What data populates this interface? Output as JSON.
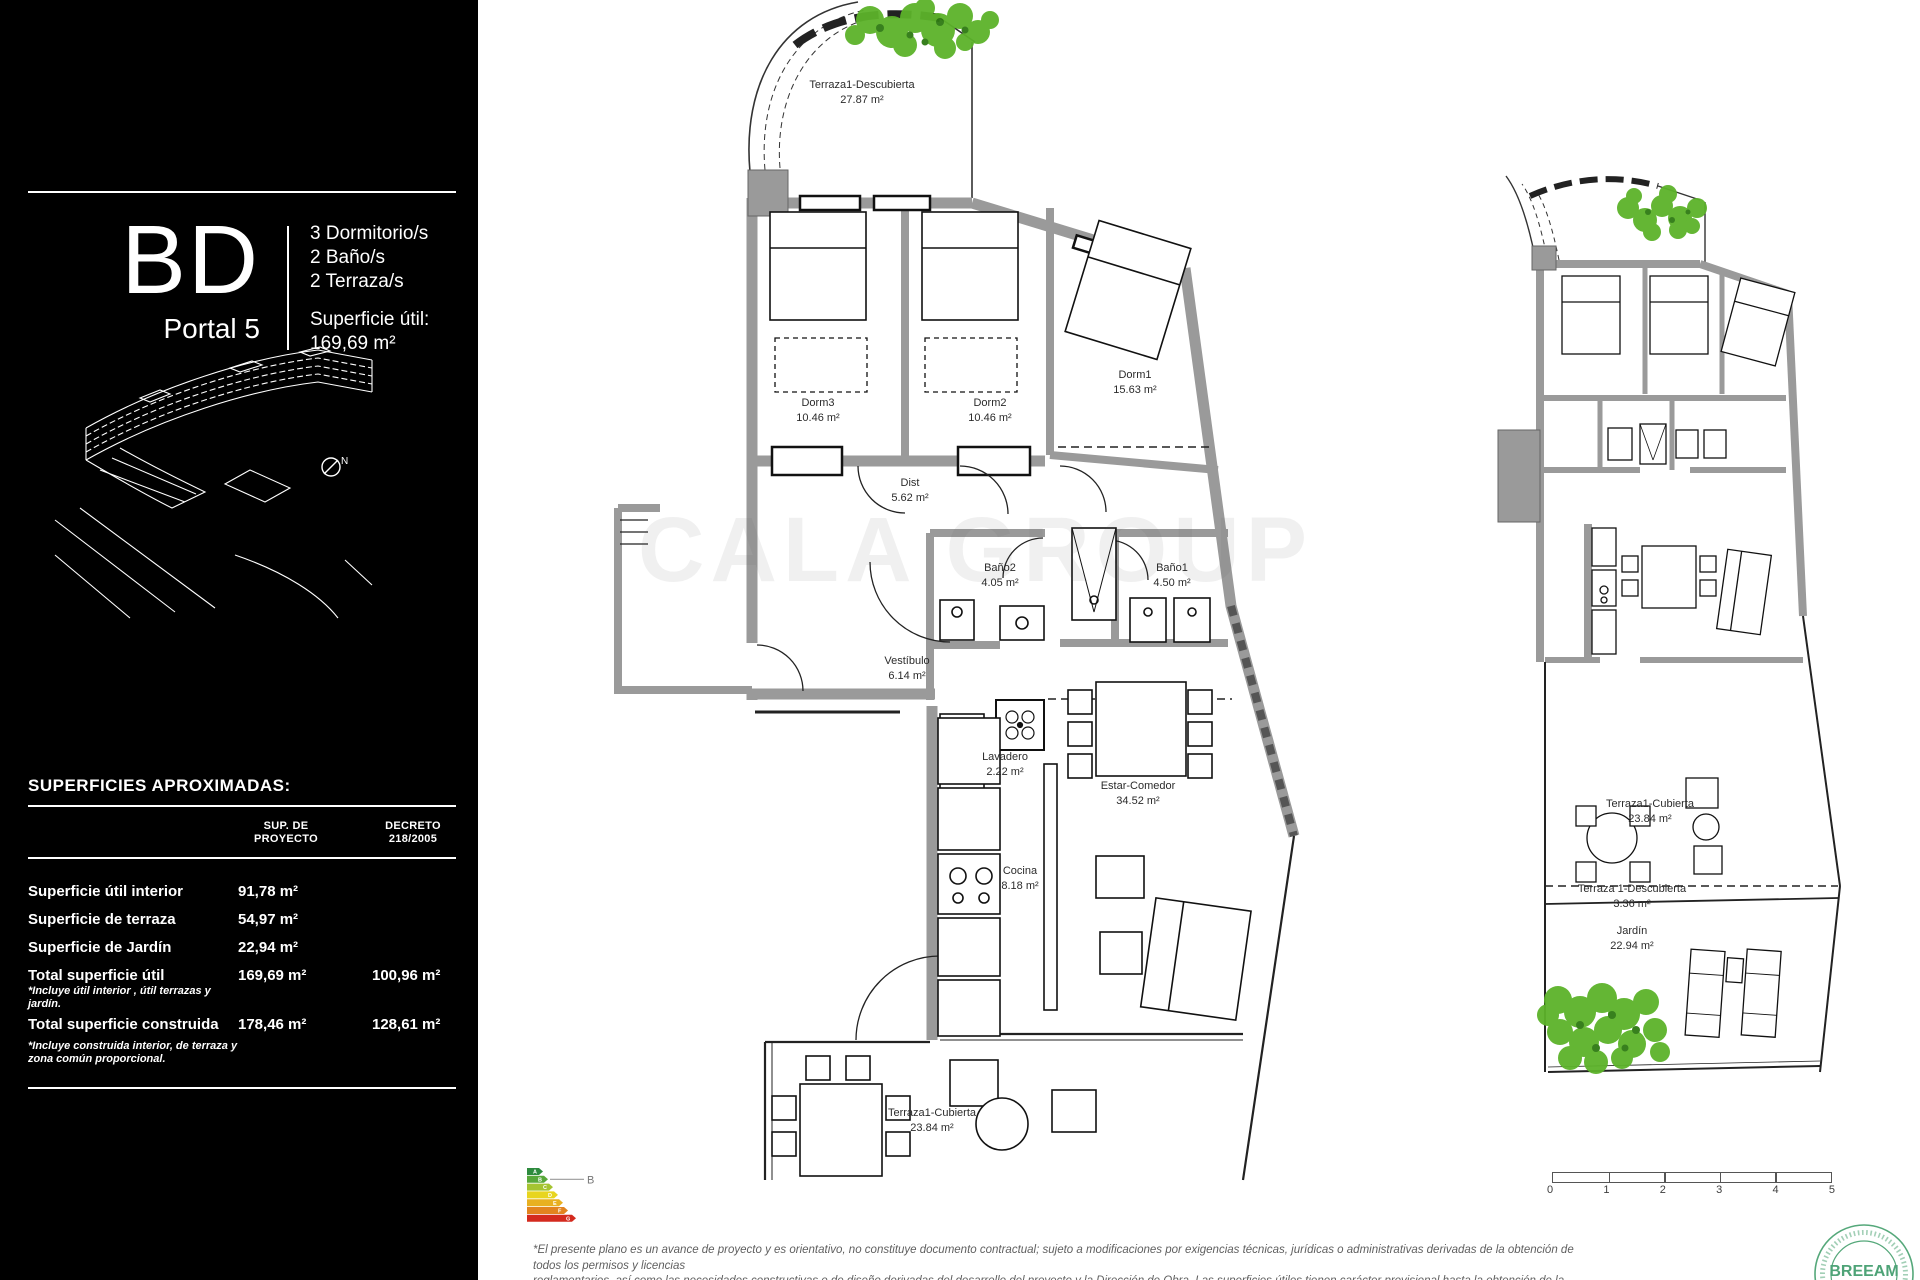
{
  "sidebar": {
    "unit_code": "BD",
    "portal": "Portal 5",
    "features": [
      "3 Dormitorio/s",
      "2 Baño/s",
      "2 Terraza/s"
    ],
    "superficie_label": "Superficie útil:",
    "superficie_value": "169,69 m²",
    "compass_label": "N",
    "table": {
      "title": "SUPERFICIES APROXIMADAS:",
      "headers": {
        "col1_line1": "SUP. DE",
        "col1_line2": "PROYECTO",
        "col2_line1": "DECRETO",
        "col2_line2": "218/2005"
      },
      "rows": [
        {
          "label": "Superficie útil interior",
          "note": "",
          "v1": "91,78  m²",
          "v2": ""
        },
        {
          "label": "Superficie de terraza",
          "note": "",
          "v1": "54,97 m²",
          "v2": ""
        },
        {
          "label": "Superficie de Jardín",
          "note": "",
          "v1": "22,94 m²",
          "v2": ""
        },
        {
          "label": "Total superficie útil",
          "note": "*Incluye útil interior , útil terrazas y jardín.",
          "v1": "169,69 m²",
          "v2": "100,96 m²"
        },
        {
          "label": "Total superficie construida",
          "note": "*Incluye construida interior, de terraza y zona común proporcional.",
          "v1": "178,46 m²",
          "v2": "128,61 m²"
        }
      ]
    }
  },
  "main_plan": {
    "rooms": [
      {
        "name": "Terraza1-Descubierta",
        "area": "27.87 m²"
      },
      {
        "name": "Dorm3",
        "area": "10.46 m²"
      },
      {
        "name": "Dorm2",
        "area": "10.46 m²"
      },
      {
        "name": "Dorm1",
        "area": "15.63 m²"
      },
      {
        "name": "Dist",
        "area": "5.62 m²"
      },
      {
        "name": "Baño2",
        "area": "4.05 m²"
      },
      {
        "name": "Baño1",
        "area": "4.50 m²"
      },
      {
        "name": "Vestíbulo",
        "area": "6.14 m²"
      },
      {
        "name": "Lavadero",
        "area": "2.22 m²"
      },
      {
        "name": "Estar-Comedor",
        "area": "34.52 m²"
      },
      {
        "name": "Cocina",
        "area": "8.18 m²"
      },
      {
        "name": "Terraza1-Cubierta",
        "area": "23.84 m²"
      }
    ]
  },
  "right_plan": {
    "rooms": [
      {
        "name": "Terraza1-Cubierta",
        "area": "23.84 m²"
      },
      {
        "name": "Terraza 1-Descubierta",
        "area": "3.36 m²"
      },
      {
        "name": "Jardín",
        "area": "22.94 m²"
      }
    ]
  },
  "watermark": "CALA GROUP",
  "energy_chart": {
    "rating": "B",
    "letters": [
      "A",
      "B",
      "C",
      "D",
      "E",
      "F",
      "G"
    ],
    "colors": [
      "#2e8b3e",
      "#58a83a",
      "#a5c431",
      "#e8d51f",
      "#e8b021",
      "#e2831f",
      "#d42a1e"
    ]
  },
  "scale_bar": {
    "ticks": [
      "0",
      "1",
      "2",
      "3",
      "4",
      "5"
    ]
  },
  "breeam": {
    "label": "BREEAM",
    "color": "#4ea377"
  },
  "disclaimer": {
    "lines": [
      "*El presente plano es un avance de proyecto y es orientativo, no constituye documento contractual; sujeto a modificaciones por exigencias técnicas, jurídicas o administrativas derivadas de la obtención de todos los permisos y licencias",
      "reglamentarios, así como las necesidades constructivas o de diseño derivadas del desarrollo del proyecto y la Dirección de Obra. Las superficies útiles tienen carácter provisional hasta la obtención de la correspondiente Licencia de Obras. La",
      "jardinería, el mobiliario urbano y el amueblamiento es ficticio, teniendo validez únicamente a efectos decorativos."
    ]
  },
  "plan_colors": {
    "wall": "#9a9a9a",
    "line": "#1c1c1c",
    "foliage": "#5cb32a"
  }
}
